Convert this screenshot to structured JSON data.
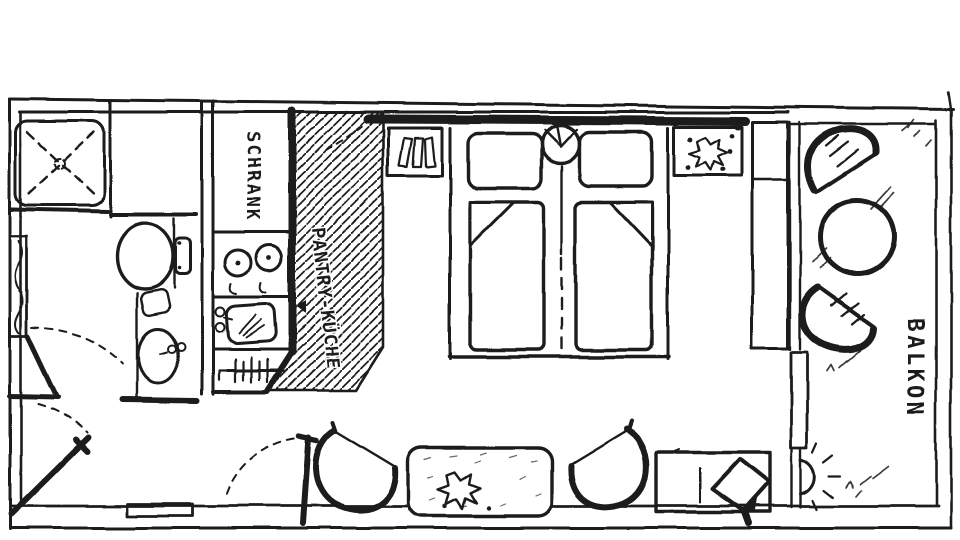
{
  "floorplan": {
    "kind": "hand-drawn hotel room floor plan",
    "labels": {
      "wardrobe": "SCHRANK",
      "kitchenette": "PANTRY-KÜCHE",
      "balcony": "BALKON"
    },
    "colors": {
      "ink": "#1b1b1b",
      "paper": "#ffffff"
    },
    "fixtures": [
      "shower",
      "toilet",
      "washbasin",
      "radiator",
      "bathroom-door",
      "entrance-door",
      "doormat",
      "room-door",
      "wardrobe",
      "hotplates",
      "kitchen-sink",
      "heater-grate",
      "pantry-floor-hatch",
      "twin-beds",
      "pillows",
      "duvets",
      "bedside-lamp",
      "nightstand-books",
      "nightstand-plant",
      "tall-cabinet",
      "window",
      "balcony-door",
      "tub-chair-left",
      "plant-table",
      "table-plant",
      "tub-chair-right",
      "desk",
      "tv",
      "balcony-chair-top",
      "balcony-round-table",
      "balcony-chair-bottom",
      "wall-lamp"
    ]
  }
}
